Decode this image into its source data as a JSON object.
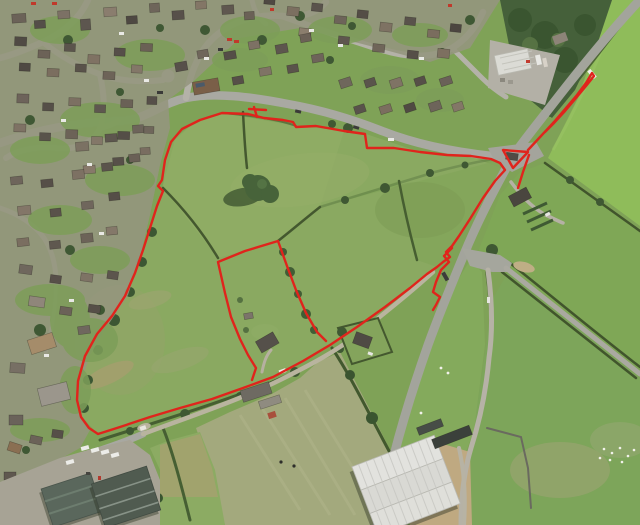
{
  "meta": {
    "title": "Aerial photograph of village-edge fields with red planning site boundary overlay",
    "image_type": "aerial-site-plan",
    "width_px": 640,
    "height_px": 525
  },
  "overlay": {
    "stroke_color": "#e0241c",
    "stroke_width": "2.4",
    "main_boundary_path": "M222 113 L248 114 L264 118 L283 120 L293 122 L296 127 L316 126 L344 131 L365 134 L367 148 L394 148 L420 152 L447 155 L471 156 L491 159 L500 163 L505 170 L495 181 L483 198 L470 219 L459 236 L452 246 L446 252 L450 257 L443 262 L437 267 L427 274 L410 288 L385 307 L357 327 L330 345 L303 361 L273 377 L243 388 L212 399 L180 408 L150 417 L120 427 L98 434 L89 428 L81 417 L77 400 L78 381 L85 356 L97 334 L112 316 L125 296 L135 273 L143 250 L150 228 L157 206 L163 191 L158 186 L162 180 L165 160 L171 142 L182 129 L200 120 Z",
    "inner_parcel_path": "M252 380 L256 368 L248 355 L240 339 L231 317 L225 293 L218 262 L245 251 L278 241 L287 266 L296 290 L306 313 L317 332 L326 341",
    "junction_triangle_path": "M503 150 L528 152 L513 168 Z",
    "road_spur_path": "M528 150 L541 136 L554 122 L566 108 L577 95 L586 83 L592 73 L594 76 L586 86 L576 98 L565 111 L553 124 L545 132 M529 155 L523 172 L518 188",
    "crossing_zigzag_path": "M452 248 L444 256 L449 262 L441 270 L436 282 L433 292 L440 297 L436 305 L433 310",
    "boundary_tick_path": "M254 107 L257 117 M249 109 L266 110"
  },
  "palette": {
    "field_green": "#8aa961",
    "bright_field_green": "#8fbc5a",
    "pale_mown_field": "#a3a97d",
    "road_gray": "#a9a9a2",
    "track_gray": "#b9b49f",
    "hedgerow_green": "#44582f",
    "woodland_green": "#45603a",
    "estate_ground": "#95967e",
    "warehouse_roof": "#e2e2de",
    "industrial_roof": "#55625a",
    "boundary_red": "#e0241c"
  }
}
